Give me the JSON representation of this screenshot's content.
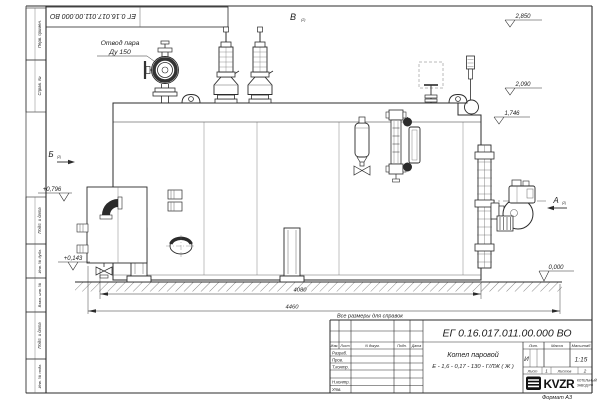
{
  "page": {
    "format_label": "Формат А3"
  },
  "frame": {
    "top_stamp_number": "ЕГ 0.16.017.011.00.000 ВО",
    "margin_labels": [
      "Перв. примен.",
      "Справ. №",
      "Подп. и дата",
      "Инв. № дубл.",
      "Взам. инв. №",
      "Подп. и дата",
      "Инв. № подл."
    ]
  },
  "drawing": {
    "note": "Все размеры для справок",
    "steam_outlet": {
      "line1": "Отвод пара",
      "line2": "Ду 150"
    },
    "views": {
      "top": {
        "label": "В",
        "sub": "(2)"
      },
      "left": {
        "label": "Б",
        "sub": "(2)"
      },
      "right": {
        "label": "А",
        "sub": "(2)"
      }
    },
    "elevations": [
      "2,850",
      "2,090",
      "1,746",
      "0,000",
      "+0,796",
      "+0,143"
    ],
    "dimensions": [
      "4080",
      "4460"
    ]
  },
  "title_block": {
    "doc_number": "ЕГ 0.16.017.011.00.000  ВО",
    "product_name": "Котел паровой",
    "product_type": "Е - 1,6 - 0,17 - 130 - Г/ЛЖ ( Ж )",
    "header_cols": [
      "Изм.",
      "Лист",
      "N докум.",
      "Подп.",
      "Дата"
    ],
    "sig_labels": [
      "Разраб.",
      "Пров.",
      "Т.контр.",
      "Н.контр.",
      "Утв."
    ],
    "lit_label": "Лит.",
    "mass_label": "Масса",
    "scale_label": "Масштаб",
    "lit_value": "И",
    "scale_value": "1:15",
    "sheet_label": "Лист",
    "sheet_value": "1",
    "sheets_label": "Листов",
    "sheets_value": "2",
    "logo_text": "KVZR",
    "company_line1": "КОТЕЛЬНЫЙ",
    "company_line2": "ЗАВОД РФ"
  }
}
